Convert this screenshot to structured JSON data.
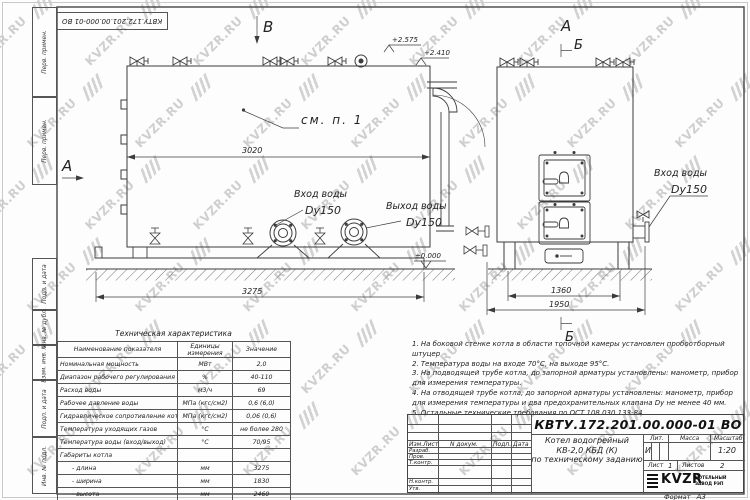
{
  "watermark": {
    "text": "KVZR.RU"
  },
  "frame": {
    "top_stamp": "КВТУ.172.201.00.000-01 ВО",
    "margin_cells": [
      "Перв. примен.",
      "Перв. примен.",
      "Подп. и дата",
      "Инв. № дубл.",
      "Взам. инв. №",
      "Подп. и дата",
      "Инв. № подл."
    ]
  },
  "side": {
    "section_a": "А",
    "view_b": "В",
    "callout": "см. п. 1",
    "dim_body": "3020",
    "dim_total": "3275",
    "elev_top": "+2.575",
    "elev_mid": "+2.410",
    "elev_zero": "±0.000",
    "inlet": "Вход воды",
    "inlet_dn": "Dy150",
    "outlet": "Выход воды",
    "outlet_dn": "Dy150"
  },
  "front": {
    "label_a": "А",
    "label_b_top": "Б",
    "label_b_bottom": "Б",
    "dim_legs": "1360",
    "dim_total": "1950",
    "inlet": "Вход воды",
    "inlet_dn": "Dy150"
  },
  "notes": [
    "1. На боковой стенке котла в области топочной камеры установлен пробоотборный штуцер",
    "2. Температура воды на входе 70°С, на выходе 95°С.",
    "3. На подводящей трубе котла, до запорной арматуры установлены: манометр, прибор для измерения температуры.",
    "4. На отводящей трубе котла, до запорной арматуры установлены: манометр, прибор для измерения температуры и два предохранительных клапана Dу не менее 40 мм.",
    "5. Остальные технические требования по ОСТ 108.030.133-84."
  ],
  "spec_table": {
    "title": "Техническая характеристика",
    "headers": [
      "Наименование показателя",
      "Единицы измерения",
      "Значение"
    ],
    "rows": [
      [
        "Номинальная мощность",
        "МВт",
        "2,0"
      ],
      [
        "Диапазон рабочего регулирования",
        "%",
        "40-110"
      ],
      [
        "Расход воды",
        "м3/ч",
        "69"
      ],
      [
        "Рабочее давление воды",
        "МПа (кгс/см2)",
        "0,6 (6,0)"
      ],
      [
        "Гидравлическое сопротивление котла",
        "МПа (кгс/см2)",
        "0,06 (0,6)"
      ],
      [
        "Температура уходящих газов",
        "°С",
        "не более 280"
      ],
      [
        "Температура воды (вход/выход)",
        "°С",
        "70/95"
      ],
      [
        "Габариты котла",
        "",
        ""
      ],
      [
        "- длина",
        "мм",
        "3275"
      ],
      [
        "- ширина",
        "мм",
        "1830"
      ],
      [
        "- высота",
        "мм",
        "2460"
      ]
    ]
  },
  "title_block": {
    "designation": "КВТУ.172.201.00.000-01 ВО",
    "cols": [
      "Изм.Лист",
      "N докум.",
      "Подп.",
      "Дата"
    ],
    "rows": [
      "Разраб.",
      "Пров.",
      "Т.контр.",
      "Н.контр.",
      "Утв."
    ],
    "name": [
      "Котел водогрейный",
      "КВ-2,0 КБД (К)",
      "по техническому заданию"
    ],
    "lit_h": "Лит.",
    "lit_v": "И",
    "mass_h": "Масса",
    "scale_h": "Масштаб",
    "scale_v": "1:20",
    "sheet_h": "Лист",
    "sheet_v": "1",
    "sheets_h": "Листов",
    "sheets_v": "2",
    "logo": "KVZR",
    "logo_sub1": "КОТЕЛЬНЫЙ",
    "logo_sub2": "ЗАВОД РЭП",
    "format_h": "Формат",
    "format_v": "А3"
  }
}
